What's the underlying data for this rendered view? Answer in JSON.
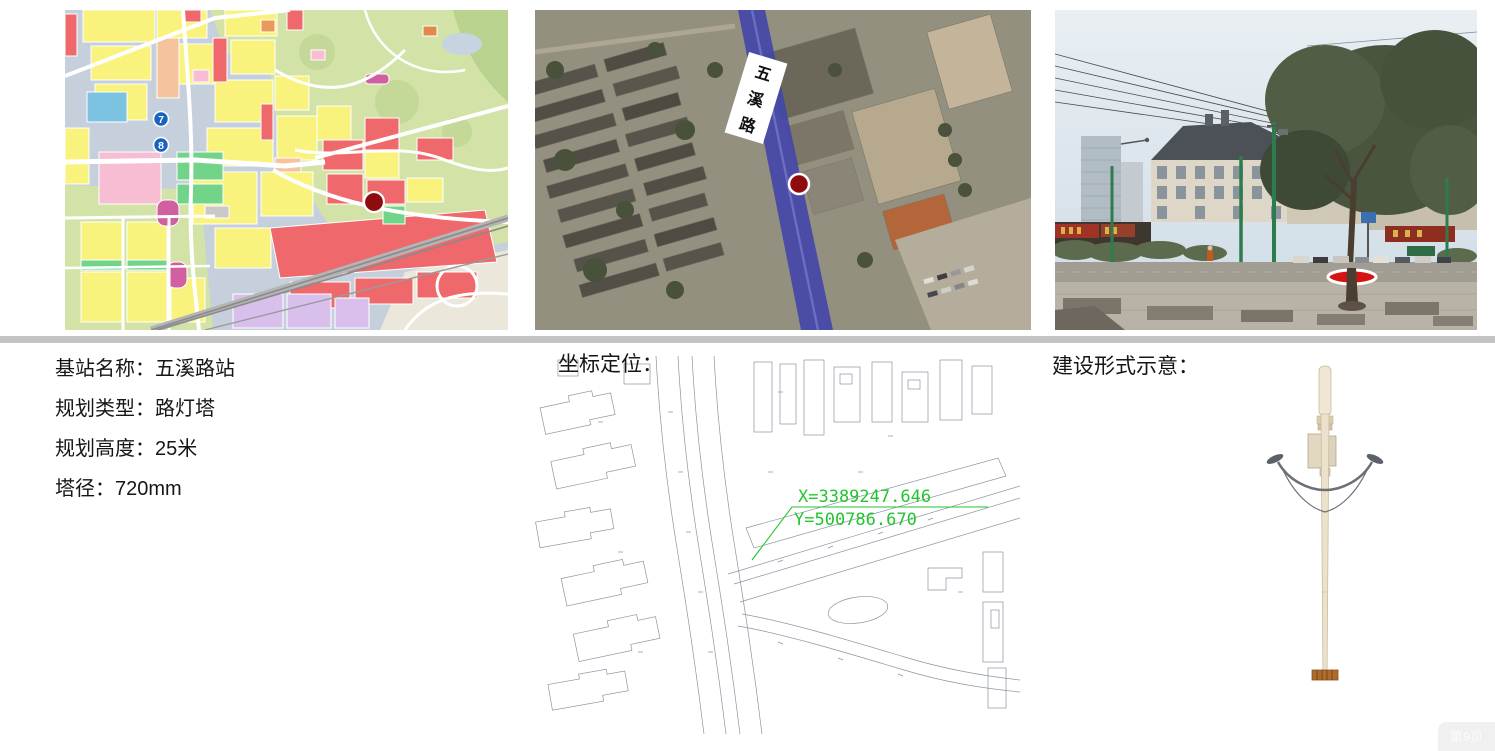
{
  "info_panel": {
    "station_name": "基站名称：五溪路站",
    "plan_type": "规划类型：路灯塔",
    "plan_height": "规划高度：25米",
    "tower_diameter": "塔径：720mm"
  },
  "coordinate_section": {
    "label": "坐标定位：",
    "coord_x": "X=3389247.646",
    "coord_y": "Y=500786.670"
  },
  "construction_section": {
    "label": "建设形式示意："
  },
  "satellite_map": {
    "road_label": "五溪路",
    "road_label_chars": [
      "五",
      "溪",
      "路"
    ]
  },
  "zoning_map": {
    "markers": [
      "7",
      "8"
    ]
  },
  "page_footer": {
    "page_indicator": "第9页"
  },
  "colors": {
    "divider_gray": "#c3c3c3",
    "cad_text_green": "#23c52f",
    "site_marker_red": "#8e0c10",
    "road_highlight_blue": "#4347a8",
    "numbered_marker_blue": "#1763be",
    "photo_marker_red": "#d41414"
  }
}
